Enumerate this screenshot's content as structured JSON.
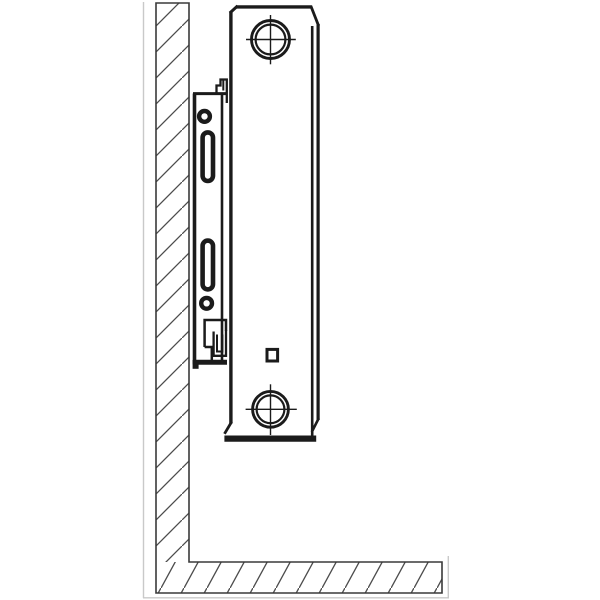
{
  "diagram": {
    "kind": "technical-line-drawing",
    "subject": "side-view of steel panel radiator mounted on wall bracket",
    "canvas": {
      "width": 600,
      "height": 600
    },
    "colors": {
      "line": "#1b1b1b",
      "outline": "#3a3a3a",
      "hatch": "#4c4c4c",
      "faint": "#c9c9c9",
      "background": "#ffffff",
      "white": "#ffffff"
    },
    "hatch_patterns": [
      {
        "id": "hatch45",
        "cw": 26,
        "ch": 26,
        "line": "M-1,27 L27,-1",
        "w": 1.3
      },
      {
        "id": "hatch60",
        "cw": 23,
        "ch": 42,
        "line": "M-1,44 L24,-2",
        "w": 1.3
      }
    ],
    "parts": [
      {
        "name": "photo-frame-artifact",
        "shapes": [
          {
            "k": "line",
            "x1": 143.5,
            "y1": 2,
            "x2": 143.5,
            "y2": 598,
            "w": 1.4,
            "c": "faint",
            "name": "frame-left-line"
          },
          {
            "k": "line",
            "x1": 143,
            "y1": 597.8,
            "x2": 449,
            "y2": 597.8,
            "w": 1.4,
            "c": "faint",
            "name": "frame-bottom-line"
          },
          {
            "k": "line",
            "x1": 448.3,
            "y1": 556,
            "x2": 448.3,
            "y2": 598,
            "w": 1.4,
            "c": "faint",
            "name": "frame-right-line"
          }
        ]
      },
      {
        "name": "wall-section",
        "shapes": [
          {
            "k": "hrect",
            "x": 156,
            "y": 3,
            "w": 33,
            "h": 559,
            "p": "hatch45",
            "name": "wall-vertical-hatch"
          },
          {
            "k": "hrect",
            "x": 156,
            "y": 562,
            "w": 286,
            "h": 31,
            "p": "hatch60",
            "name": "wall-floor-hatch"
          },
          {
            "k": "path",
            "d": "M156,3 H189 V562 H442 V593 H156 Z",
            "sw": 1.6,
            "c": "outline",
            "name": "wall-outline"
          }
        ]
      },
      {
        "name": "mounting-bracket",
        "shapes": [
          {
            "k": "line",
            "x1": 194.5,
            "y1": 93.5,
            "x2": 194.5,
            "y2": 364,
            "w": 3.6,
            "name": "bracket-plate-left-edge"
          },
          {
            "k": "line",
            "x1": 193,
            "y1": 93.6,
            "x2": 226.8,
            "y2": 93.6,
            "w": 3.0,
            "name": "bracket-plate-top-edge"
          },
          {
            "k": "line",
            "x1": 222,
            "y1": 95,
            "x2": 222,
            "y2": 361,
            "w": 2.6,
            "name": "bracket-plate-right-edge"
          },
          {
            "k": "line",
            "x1": 192.8,
            "y1": 362.2,
            "x2": 227,
            "y2": 362.2,
            "w": 5.0,
            "name": "bracket-plate-bottom-edge"
          },
          {
            "k": "rect",
            "x": 192.6,
            "y": 360,
            "w": 6,
            "h": 8.8,
            "f": "line",
            "name": "bracket-foot"
          },
          {
            "k": "circle",
            "cx": 204.5,
            "cy": 116.4,
            "r": 5.4,
            "sw": 4.4,
            "f": "white",
            "name": "bracket-upper-hole"
          },
          {
            "k": "rect",
            "x": 202.6,
            "y": 132.4,
            "w": 10.4,
            "h": 48.6,
            "rx": 5.2,
            "sw": 4.6,
            "f": "white",
            "name": "bracket-upper-slot"
          },
          {
            "k": "rect",
            "x": 202.6,
            "y": 240.6,
            "w": 10.4,
            "h": 48.8,
            "rx": 5.2,
            "sw": 4.6,
            "f": "white",
            "name": "bracket-lower-slot"
          },
          {
            "k": "circle",
            "cx": 206.6,
            "cy": 303.3,
            "r": 5.4,
            "sw": 4.4,
            "f": "white",
            "name": "bracket-lower-hole"
          },
          {
            "k": "polyline",
            "pts": "216.5,93.5 216.5,85.5 220.5,85.5 220.5,79.5 226.8,79.5 226.8,103",
            "w": 2.3,
            "name": "bracket-top-clip"
          },
          {
            "k": "line",
            "x1": 223.3,
            "y1": 79.5,
            "x2": 223.3,
            "y2": 90.5,
            "w": 2.0,
            "name": "bracket-top-clip-inner"
          },
          {
            "k": "polyline",
            "pts": "204.6,347 204.6,320 226,320 226,331",
            "w": 2.5,
            "name": "bracket-lower-housing"
          },
          {
            "k": "polyline",
            "pts": "204.6,347 211.8,347 211.8,360.5",
            "w": 2.5,
            "name": "bracket-lower-housing-step"
          },
          {
            "k": "polyline",
            "pts": "213.6,331.5 213.6,355.8 226,355.8 226,330.4",
            "w": 2.3,
            "name": "bracket-bottom-clip"
          },
          {
            "k": "polyline",
            "pts": "217,334.5 217,351.5 222.4,351.5 222.4,334.5",
            "w": 2.0,
            "name": "bracket-bottom-clip-inner"
          }
        ]
      },
      {
        "name": "radiator-panel",
        "shapes": [
          {
            "k": "line",
            "x1": 230.9,
            "y1": 11.5,
            "x2": 230.9,
            "y2": 423.5,
            "w": 3.4,
            "name": "radiator-back-edge"
          },
          {
            "k": "line",
            "x1": 230.9,
            "y1": 12,
            "x2": 236.5,
            "y2": 6.9,
            "w": 3.0,
            "cap": "square",
            "name": "radiator-top-left-chamfer"
          },
          {
            "k": "line",
            "x1": 236,
            "y1": 6.9,
            "x2": 311.2,
            "y2": 6.9,
            "w": 3.4,
            "name": "radiator-top-edge"
          },
          {
            "k": "line",
            "x1": 311.2,
            "y1": 6.9,
            "x2": 318.1,
            "y2": 24.5,
            "w": 2.8,
            "cap": "square",
            "name": "radiator-top-right-chamfer"
          },
          {
            "k": "line",
            "x1": 318.1,
            "y1": 24,
            "x2": 318.1,
            "y2": 420,
            "w": 3.2,
            "name": "radiator-front-outer-edge"
          },
          {
            "k": "line",
            "x1": 312.2,
            "y1": 26,
            "x2": 312.2,
            "y2": 436,
            "w": 2.6,
            "name": "radiator-front-inner-edge"
          },
          {
            "k": "line",
            "x1": 318.1,
            "y1": 419.5,
            "x2": 312.4,
            "y2": 430.8,
            "w": 2.6,
            "cap": "square",
            "name": "radiator-bottom-right-chamfer"
          },
          {
            "k": "line",
            "x1": 230.9,
            "y1": 423,
            "x2": 225.2,
            "y2": 432.6,
            "w": 2.8,
            "cap": "square",
            "name": "radiator-bottom-left-chamfer"
          },
          {
            "k": "line",
            "x1": 224.4,
            "y1": 438.6,
            "x2": 316.2,
            "y2": 438.6,
            "w": 6.2,
            "name": "radiator-bottom-edge"
          },
          {
            "k": "circle",
            "cx": 270.5,
            "cy": 39.5,
            "r": 19.0,
            "sw": 2.9,
            "name": "top-port-outer-circle"
          },
          {
            "k": "circle",
            "cx": 270.5,
            "cy": 39.5,
            "r": 14.9,
            "sw": 2.2,
            "name": "top-port-inner-circle"
          },
          {
            "k": "line",
            "x1": 246,
            "y1": 39.5,
            "x2": 295.8,
            "y2": 39.5,
            "w": 1.4,
            "name": "top-port-crosshair-h"
          },
          {
            "k": "line",
            "x1": 270.5,
            "y1": 15,
            "x2": 270.5,
            "y2": 64.3,
            "w": 1.4,
            "name": "top-port-crosshair-v"
          },
          {
            "k": "circle",
            "cx": 270.5,
            "cy": 409.3,
            "r": 17.9,
            "sw": 2.9,
            "name": "bottom-port-outer-circle"
          },
          {
            "k": "circle",
            "cx": 270.5,
            "cy": 409.3,
            "r": 13.9,
            "sw": 2.2,
            "name": "bottom-port-inner-circle"
          },
          {
            "k": "line",
            "x1": 245.6,
            "y1": 409.3,
            "x2": 296.8,
            "y2": 409.3,
            "w": 1.4,
            "name": "bottom-port-crosshair-h"
          },
          {
            "k": "line",
            "x1": 270.5,
            "y1": 384.3,
            "x2": 270.5,
            "y2": 435,
            "w": 1.4,
            "name": "bottom-port-crosshair-v"
          },
          {
            "k": "rect",
            "x": 267,
            "y": 349.4,
            "w": 10.6,
            "h": 11.6,
            "sw": 3.0,
            "f": "white",
            "name": "radiator-vent-square"
          }
        ]
      }
    ]
  }
}
